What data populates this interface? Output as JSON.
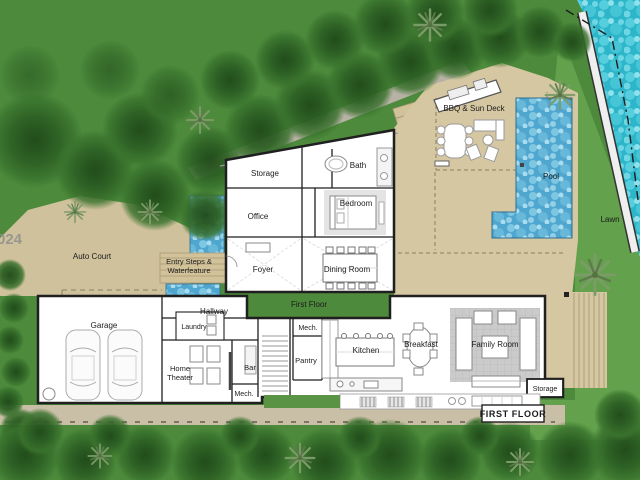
{
  "plan_title": "FIRST FLOOR",
  "watermark": "024",
  "rooms": {
    "storage_upper": "Storage",
    "office": "Office",
    "bath": "Bath",
    "bedroom": "Bedroom",
    "foyer": "Foyer",
    "dining_room": "Dining Room",
    "first_floor": "First Floor",
    "hallway": "Hallway",
    "laundry": "Laundry",
    "garage": "Garage",
    "home_theater_line1": "Home",
    "home_theater_line2": "Theater",
    "bar": "Bar",
    "mech_lower": "Mech.",
    "mech_upper": "Mech.",
    "pantry": "Pantry",
    "kitchen": "Kitchen",
    "breakfast": "Breakfast",
    "family_room": "Family Room",
    "storage_right": "Storage"
  },
  "outdoor": {
    "auto_court": "Auto Court",
    "entry_line1": "Entry Steps &",
    "entry_line2": "Waterfeature",
    "bbq_sun_deck": "BBQ & Sun Deck",
    "pool": "Pool",
    "lawn": "Lawn"
  },
  "colors": {
    "grass": "#4d8a3c",
    "lawn": "#63a14c",
    "tree": "#2e6125",
    "deck_tan": "#d5c7a1",
    "auto_court_tan": "#cfc19c",
    "pool_blue": "#4fa6cf",
    "bay_water": "#2db6ca",
    "wall": "#1f1f1f"
  }
}
